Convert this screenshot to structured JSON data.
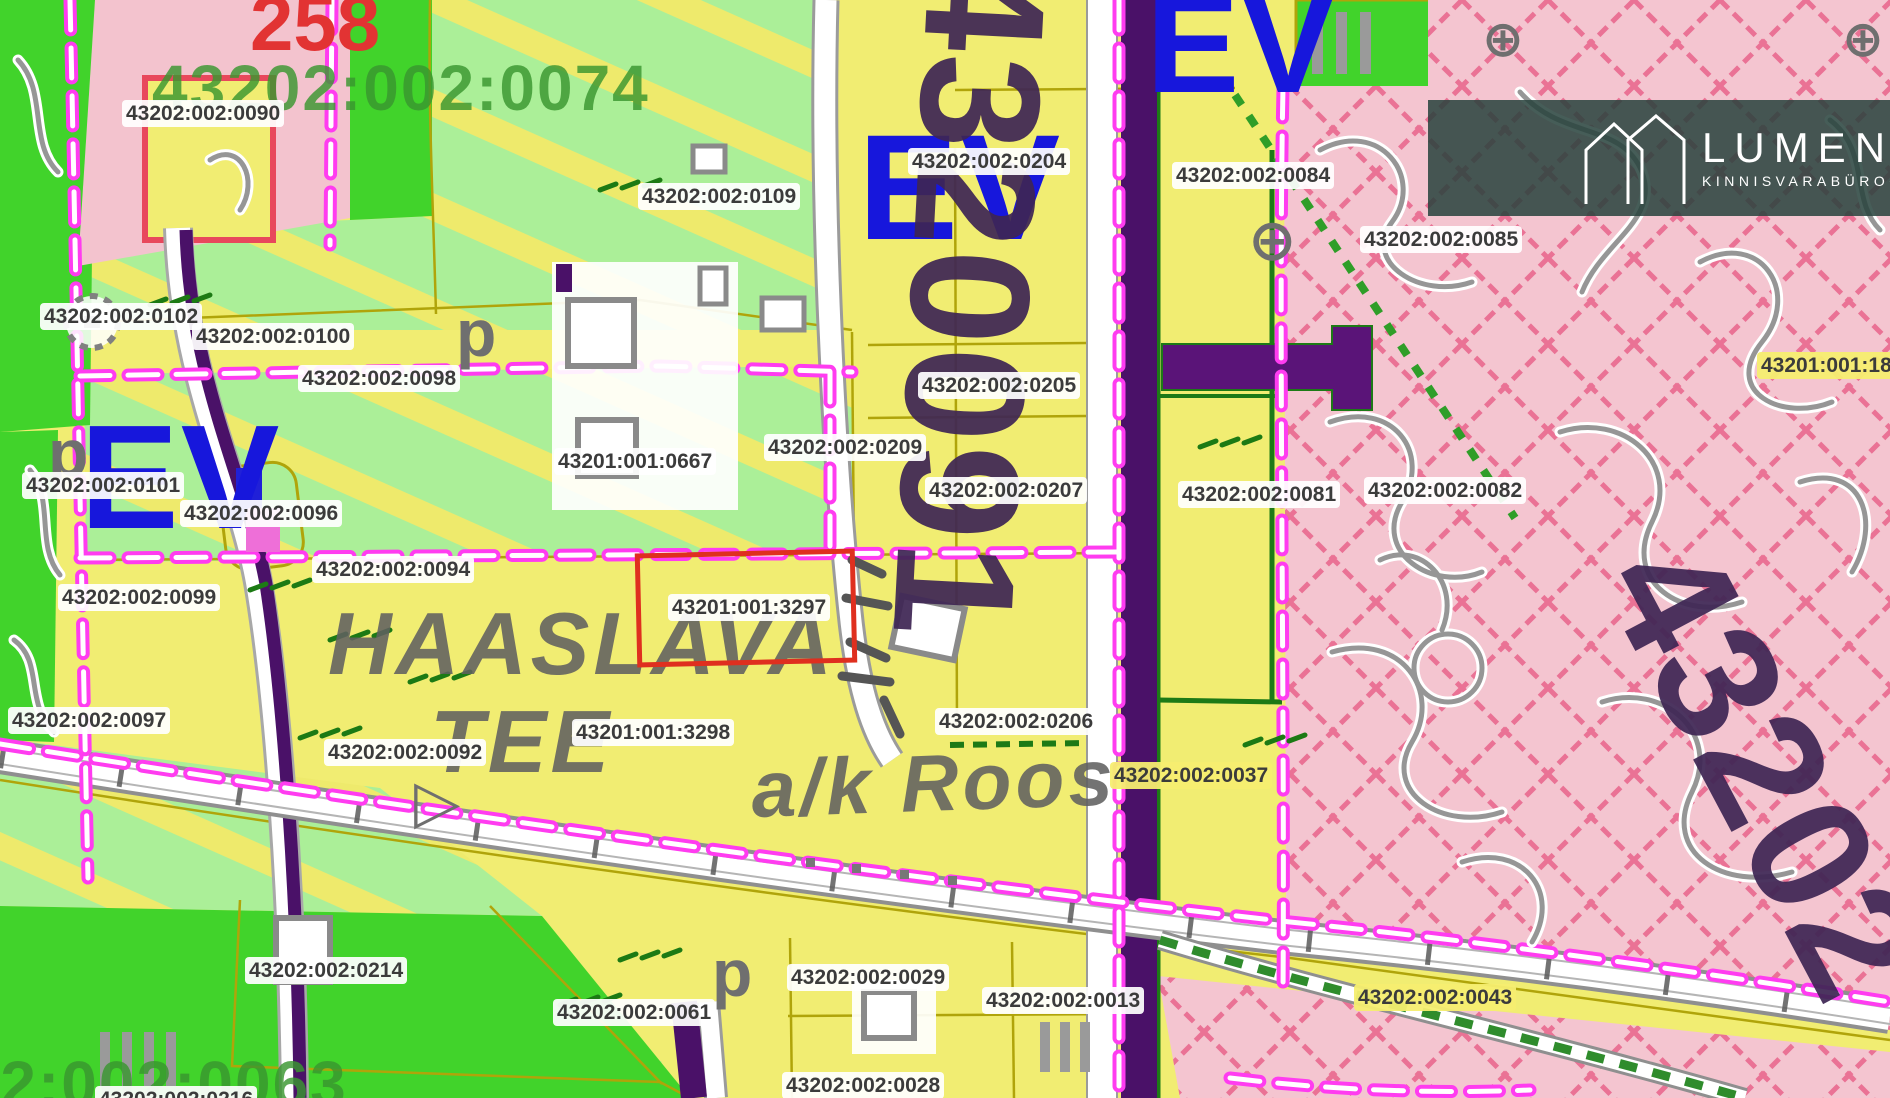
{
  "map": {
    "parcel_labels": [
      {
        "text": "43202:002:0090",
        "x": 122,
        "y": 100
      },
      {
        "text": "43202:002:0109",
        "x": 638,
        "y": 183
      },
      {
        "text": "43202:002:0204",
        "x": 908,
        "y": 148
      },
      {
        "text": "43202:002:0084",
        "x": 1172,
        "y": 162
      },
      {
        "text": "43202:002:0085",
        "x": 1360,
        "y": 226
      },
      {
        "text": "43202:002:0102",
        "x": 40,
        "y": 303
      },
      {
        "text": "43202:002:0100",
        "x": 192,
        "y": 323
      },
      {
        "text": "43202:002:0098",
        "x": 298,
        "y": 365
      },
      {
        "text": "43202:002:0205",
        "x": 918,
        "y": 372
      },
      {
        "text": "43201:001:18",
        "x": 1757,
        "y": 352,
        "v": "yellow"
      },
      {
        "text": "43202:002:0101",
        "x": 22,
        "y": 472
      },
      {
        "text": "43202:002:0096",
        "x": 180,
        "y": 500
      },
      {
        "text": "43201:001:0667",
        "x": 554,
        "y": 448
      },
      {
        "text": "43202:002:0209",
        "x": 764,
        "y": 434
      },
      {
        "text": "43202:002:0207",
        "x": 925,
        "y": 477
      },
      {
        "text": "43202:002:0081",
        "x": 1178,
        "y": 481
      },
      {
        "text": "43202:002:0082",
        "x": 1364,
        "y": 477
      },
      {
        "text": "43202:002:0094",
        "x": 312,
        "y": 556
      },
      {
        "text": "43202:002:0099",
        "x": 58,
        "y": 584
      },
      {
        "text": "43201:001:3297",
        "x": 668,
        "y": 594
      },
      {
        "text": "43202:002:0097",
        "x": 8,
        "y": 707
      },
      {
        "text": "43202:002:0092",
        "x": 324,
        "y": 739
      },
      {
        "text": "43201:001:3298",
        "x": 572,
        "y": 719
      },
      {
        "text": "43202:002:0206",
        "x": 935,
        "y": 708
      },
      {
        "text": "43202:002:0037",
        "x": 1110,
        "y": 762,
        "v": "yellow"
      },
      {
        "text": "43202:002:0214",
        "x": 245,
        "y": 957
      },
      {
        "text": "43202:002:0061",
        "x": 553,
        "y": 999
      },
      {
        "text": "43202:002:0029",
        "x": 787,
        "y": 964
      },
      {
        "text": "43202:002:0013",
        "x": 982,
        "y": 987
      },
      {
        "text": "43202:002:0043",
        "x": 1354,
        "y": 984,
        "v": "yellow"
      },
      {
        "text": "43202:002:0028",
        "x": 782,
        "y": 1072
      },
      {
        "text": "43202:002:0216",
        "x": 95,
        "y": 1086
      }
    ],
    "display_texts": [
      {
        "text": "258",
        "cls": "plannum",
        "x": 250,
        "y": -16,
        "size": 78
      },
      {
        "text": "43202:002:0074",
        "cls": "biggreen",
        "x": 152,
        "y": 56,
        "size": 64
      },
      {
        "text": "43202:002:0063",
        "cls": "biggreen",
        "x": -150,
        "y": 1052,
        "size": 64
      },
      {
        "text": "EV",
        "cls": "ev",
        "x": 80,
        "y": 404,
        "size": 148
      },
      {
        "text": "EV",
        "cls": "ev",
        "x": 858,
        "y": 112,
        "size": 150
      },
      {
        "text": "EV",
        "cls": "ev",
        "x": 1146,
        "y": -26,
        "size": 140
      },
      {
        "text": "4320091",
        "cls": "roadcode",
        "x": 1072,
        "y": -38,
        "size": 170,
        "rot": 93
      },
      {
        "text": "43202",
        "cls": "roadcode",
        "x": 1725,
        "y": 515,
        "size": 170,
        "rot": 62
      },
      {
        "text": "HAASLAVA",
        "cls": "placename",
        "x": 328,
        "y": 600,
        "size": 88
      },
      {
        "text": "TEE",
        "cls": "placename",
        "x": 430,
        "y": 698,
        "size": 88
      },
      {
        "text": "a/k Roos",
        "cls": "placename",
        "x": 750,
        "y": 750,
        "size": 80,
        "rot": -2
      },
      {
        "text": "p",
        "cls": "sym",
        "x": 48,
        "y": 420,
        "size": 66
      },
      {
        "text": "p",
        "cls": "sym",
        "x": 456,
        "y": 300,
        "size": 66
      },
      {
        "text": "p",
        "cls": "sym",
        "x": 712,
        "y": 940,
        "size": 66
      },
      {
        "text": "▷",
        "cls": "sym",
        "x": 414,
        "y": 772,
        "size": 60
      },
      {
        "text": "⊕",
        "cls": "sym",
        "x": 1248,
        "y": 212,
        "size": 58
      },
      {
        "text": "⊕",
        "cls": "sym",
        "x": 1482,
        "y": 14,
        "size": 50
      },
      {
        "text": "⊕",
        "cls": "sym",
        "x": 1842,
        "y": 14,
        "size": 50
      }
    ],
    "highlighted_parcel": "43201:001:3297",
    "logo": {
      "name": "LUMEN",
      "subtitle": "KINNISVARABÜROO"
    },
    "colors": {
      "base_yellow": "#f1ed72",
      "bright_green": "#41d32b",
      "pale_green": "#abef98",
      "pink": "#f4c5d0",
      "purple_road": "#4a1168",
      "magenta_boundary": "#ff3cf0",
      "olive_line": "#b0a40a",
      "dark_green_line": "#1d7a16",
      "highlight_red": "#df2f1f",
      "ev_blue": "#1717dc",
      "label_text": "#3b3b3b",
      "crimson_hatch": "#e23a6e"
    }
  }
}
